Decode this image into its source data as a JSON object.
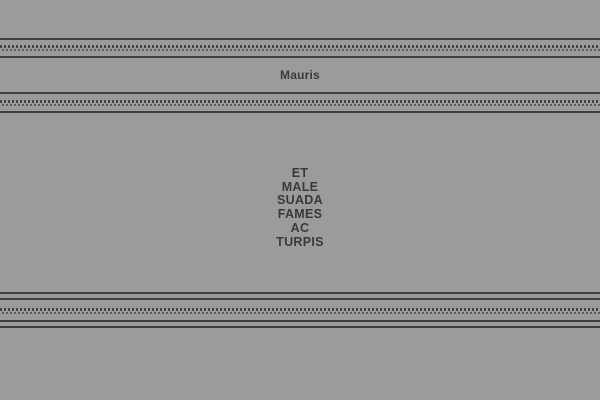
{
  "header": {
    "title": "Mauris"
  },
  "content": {
    "lines": [
      "ET",
      "MALE",
      "SUADA",
      "FAMES",
      "AC",
      "TURPIS"
    ]
  },
  "colors": {
    "background": "#9b9b9b",
    "rule": "#3e3e3e",
    "dots_primary": "#474747",
    "dots_secondary": "#5e5e5e",
    "text": "#3a3a3a"
  }
}
